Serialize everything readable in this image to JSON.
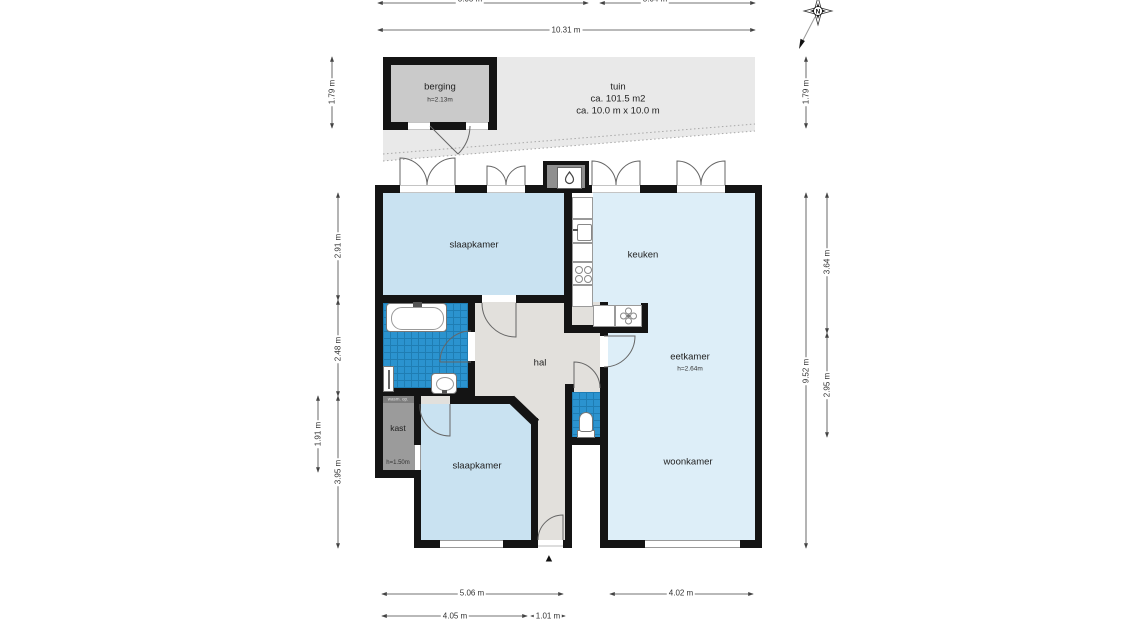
{
  "plan": {
    "compass_label": "N",
    "entrance_marker": "▲"
  },
  "rooms": {
    "berging": {
      "label": "berging",
      "height": "h=2.13m"
    },
    "tuin": {
      "label": "tuin",
      "area": "ca. 101.5 m2",
      "size": "ca. 10.0 m x 10.0 m"
    },
    "slaapkamer_1": {
      "label": "slaapkamer"
    },
    "keuken": {
      "label": "keuken"
    },
    "hal": {
      "label": "hal"
    },
    "eetkamer": {
      "label": "eetkamer",
      "height": "h=2.64m"
    },
    "woonkamer": {
      "label": "woonkamer"
    },
    "kast": {
      "label": "kast",
      "height": "h=1.50m",
      "note": "wasm. op."
    },
    "slaapkamer_2": {
      "label": "slaapkamer"
    }
  },
  "dimensions": {
    "top_total": "10.31 m",
    "top_seg_left": "5.05 m",
    "top_seg_right": "5.04 m",
    "left_tuin": "1.79 m",
    "left_slaapkamer": "2.91 m",
    "left_badkamer": "2.48 m",
    "left_kast": "1.91 m",
    "left_bottom": "3.95 m",
    "right_tuin": "1.79 m",
    "right_keuken": "3.64 m",
    "right_total": "9.52 m",
    "right_eetkamer": "2.95 m",
    "bottom_house_left": "5.06 m",
    "bottom_house_right": "4.02 m",
    "bottom_slaapkamer": "4.05 m",
    "bottom_entrance": "1.01 m"
  },
  "colors": {
    "wall": "#141414",
    "bedroom_fill": "#c9e2f1",
    "living_fill": "#ddeef8",
    "tile_fill": "#2b93cf",
    "hall_fill": "#e2e0dc",
    "closet_fill": "#9b9b9b",
    "garden_fill": "#e9e9e9",
    "storage_fill": "#cacaca"
  }
}
